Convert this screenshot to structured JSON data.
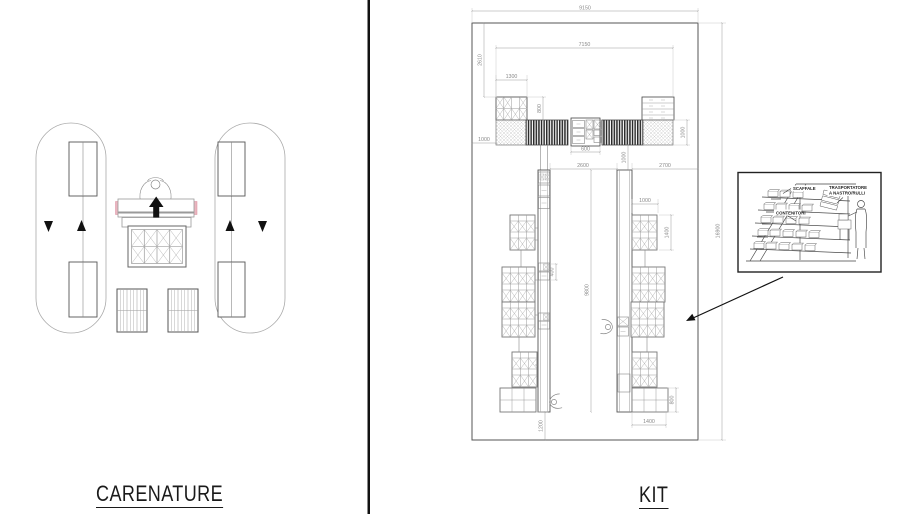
{
  "page": {
    "background": "#ffffff",
    "divider_color": "#111111"
  },
  "sections": {
    "carenature": {
      "label": "CARENATURE"
    },
    "kit": {
      "label": "KIT"
    }
  },
  "kit_plan": {
    "dimensions": {
      "overall_width": "9150",
      "overall_height": "16900",
      "inner_width": "7150",
      "top_left_height": "2610",
      "left_block_width": "1300",
      "left_block_depth": "800",
      "left_margin": "1000",
      "band_depth_right": "1000",
      "center_station_width": "600",
      "band_to_lane_gap": "1000",
      "left_aisle_width": "2600",
      "right_aisle_width": "2700",
      "lane_length": "9800",
      "pallet_width": "1000",
      "pallet_depth": "1400",
      "station_depth": "400",
      "bottom_margin": "1200",
      "end_pallet_depth": "800",
      "end_pallet_width": "1400"
    }
  },
  "inset": {
    "labels": {
      "scaffale": "SCAFFALE",
      "trasportatore_line1": "TRASPORTATORE",
      "trasportatore_line2": "A NASTRO/RULLI",
      "contenitori": "CONTENITORI"
    }
  },
  "colors": {
    "line": "#666666",
    "dim_text": "#8a8a8a",
    "conveyor_dark": "#2b2b2b",
    "bench_accent": "#eab6c0",
    "arrow_black": "#111111"
  }
}
